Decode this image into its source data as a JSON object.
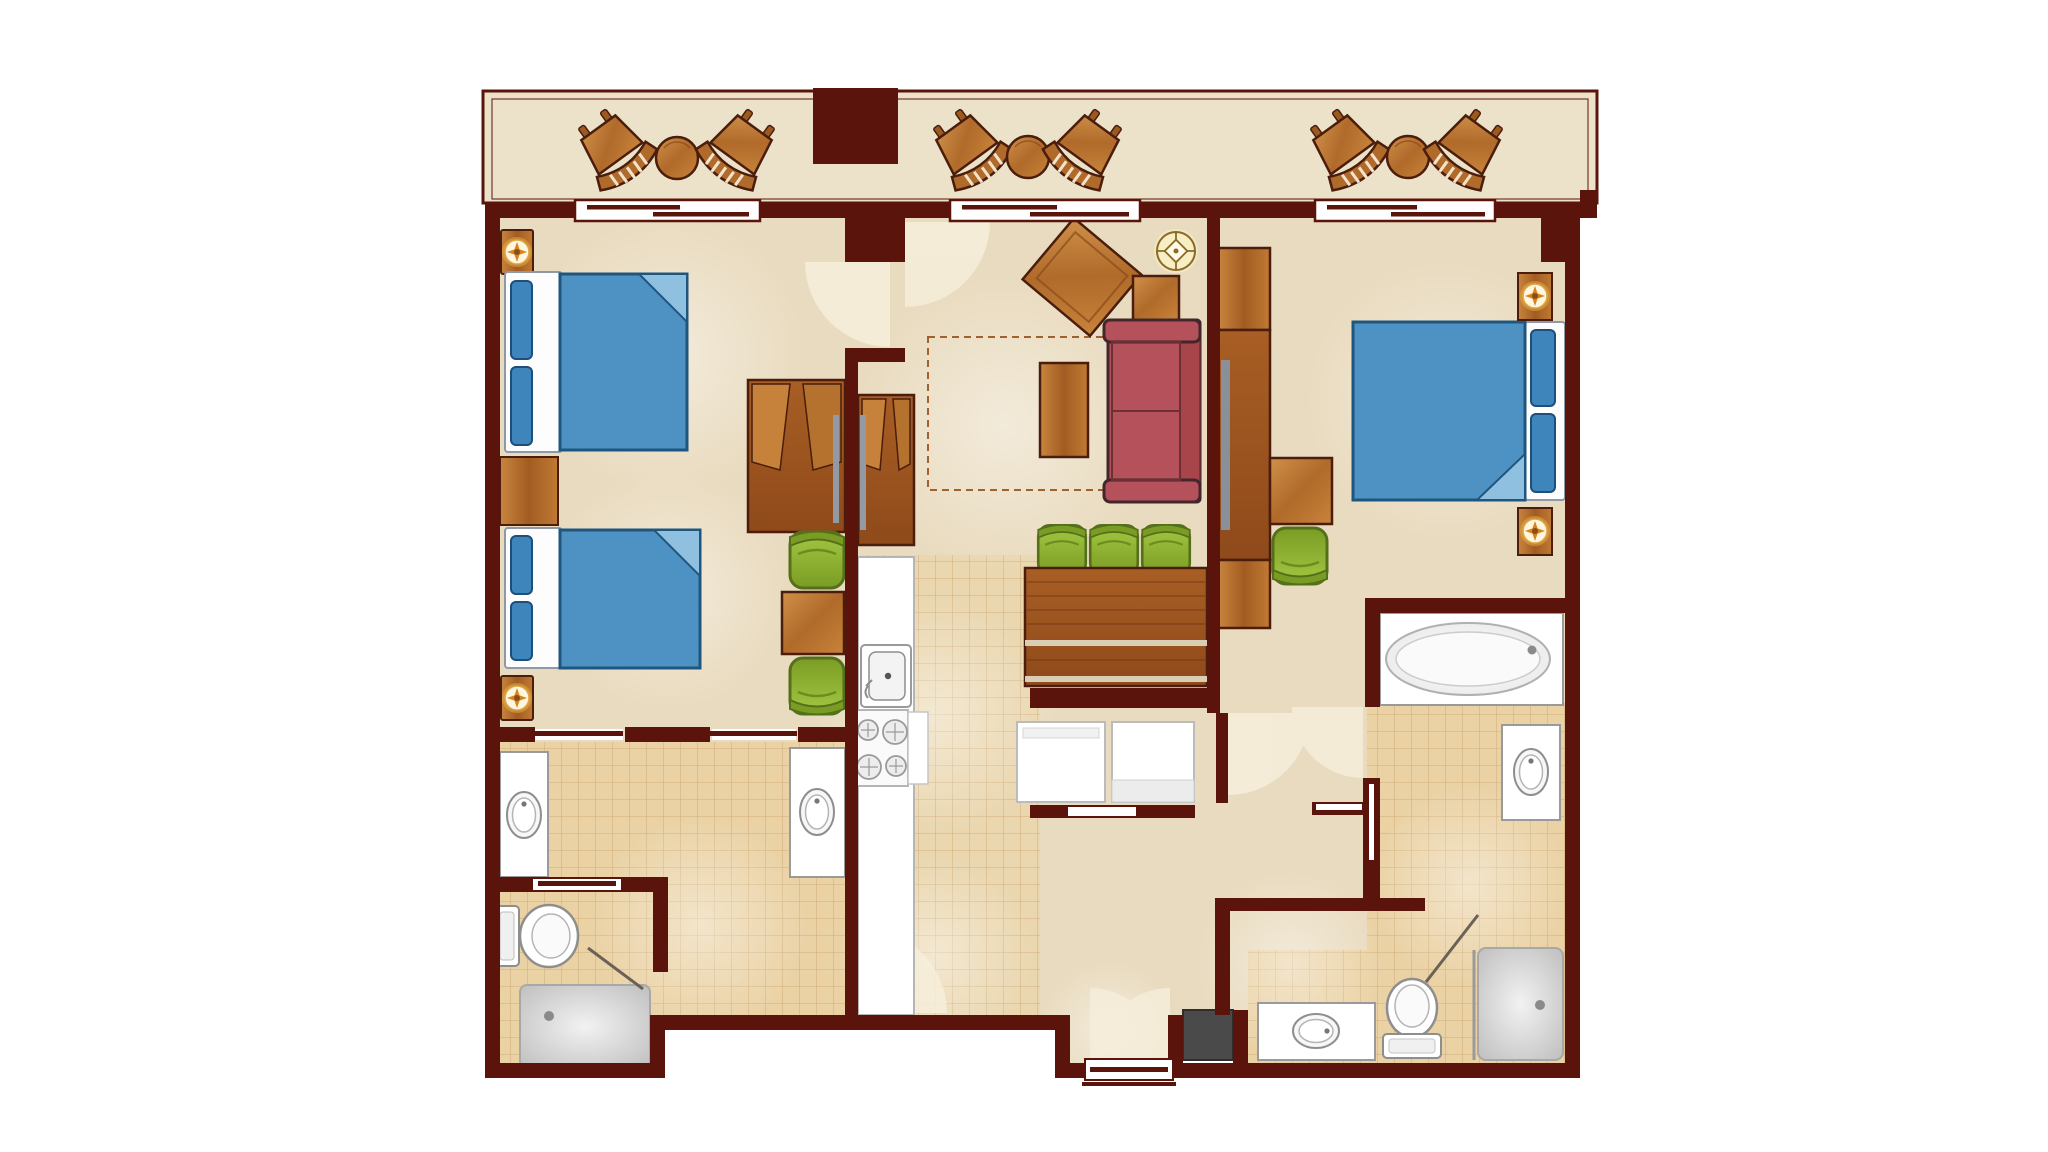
{
  "meta": {
    "type": "floor-plan",
    "description": "Top-down architectural floor plan of a two-bedroom resort villa with front balcony",
    "text_visible": ""
  },
  "palette": {
    "wall": "#5a140c",
    "balcony_floor": "#ece2c9",
    "room_floor": "#e9dbbf",
    "tile_floor": "#ead7b0",
    "tile_floor_bath": "#ead2a5",
    "tile_line": "#c49a62",
    "wood": "#b5722f",
    "wood_dark_outline": "#4a1d0c",
    "bed_blue": "#4e92c4",
    "bed_blue_dark": "#1f567f",
    "pillow_blue": "#3d85bb",
    "fold_blue": "#8fc0e0",
    "sofa_red": "#b4515a",
    "sofa_red_outline": "#42262b",
    "chair_green": "#8fb32c",
    "chair_green_dark": "#55701a",
    "fixture_white": "#ffffff",
    "fixture_stroke": "#8e8e8e",
    "shower_gray": "#d9d9d9",
    "appliance_gray": "#4a4a4a",
    "tv_gray": "#8a9099",
    "lamp_glow": "#f8eec6",
    "sconce_orange": "#d9821f",
    "door_swing": "#f6eedb"
  },
  "balcony": {
    "name": "balcony",
    "furniture": [
      "rocking-chair",
      "rocking-chair",
      "side-table",
      "rocking-chair",
      "rocking-chair",
      "side-table",
      "rocking-chair",
      "rocking-chair",
      "side-table"
    ],
    "structure": [
      "column-block",
      "sliding-glass-door",
      "sliding-glass-door",
      "sliding-glass-door"
    ]
  },
  "rooms": [
    {
      "name": "bedroom-left",
      "furniture": [
        "queen-bed",
        "queen-bed",
        "nightstand",
        "wall-sconce",
        "wall-sconce",
        "armoire",
        "side-table",
        "barrel-chair",
        "barrel-chair"
      ]
    },
    {
      "name": "bathroom-left",
      "fixtures": [
        "vanity-sink",
        "vanity-sink",
        "toilet",
        "shower",
        "pocket-door",
        "pocket-door",
        "pocket-door"
      ]
    },
    {
      "name": "kitchen",
      "fixtures": [
        "counter",
        "kitchen-sink",
        "range-4-burner",
        "pantry-closet"
      ]
    },
    {
      "name": "dining-area",
      "furniture": [
        "dining-table",
        "bench",
        "dining-chair",
        "dining-chair",
        "dining-chair"
      ]
    },
    {
      "name": "living-room",
      "furniture": [
        "sleeper-sofa",
        "sleeper-outline-dashed",
        "coffee-table",
        "side-table",
        "tilted-table",
        "ceiling-lamp",
        "media-cabinet"
      ]
    },
    {
      "name": "laundry-closet",
      "fixtures": [
        "washer",
        "dryer"
      ]
    },
    {
      "name": "bedroom-right",
      "furniture": [
        "king-bed",
        "nightstand",
        "nightstand",
        "wall-sconce",
        "wall-sconce",
        "desk",
        "barrel-chair",
        "tv-cabinet"
      ]
    },
    {
      "name": "bathroom-right",
      "fixtures": [
        "soaking-tub",
        "vanity-sink",
        "vanity-sink",
        "toilet",
        "shower",
        "utility-cube"
      ]
    },
    {
      "name": "entry",
      "fixtures": [
        "entry-door",
        "double-door-swing"
      ]
    }
  ]
}
